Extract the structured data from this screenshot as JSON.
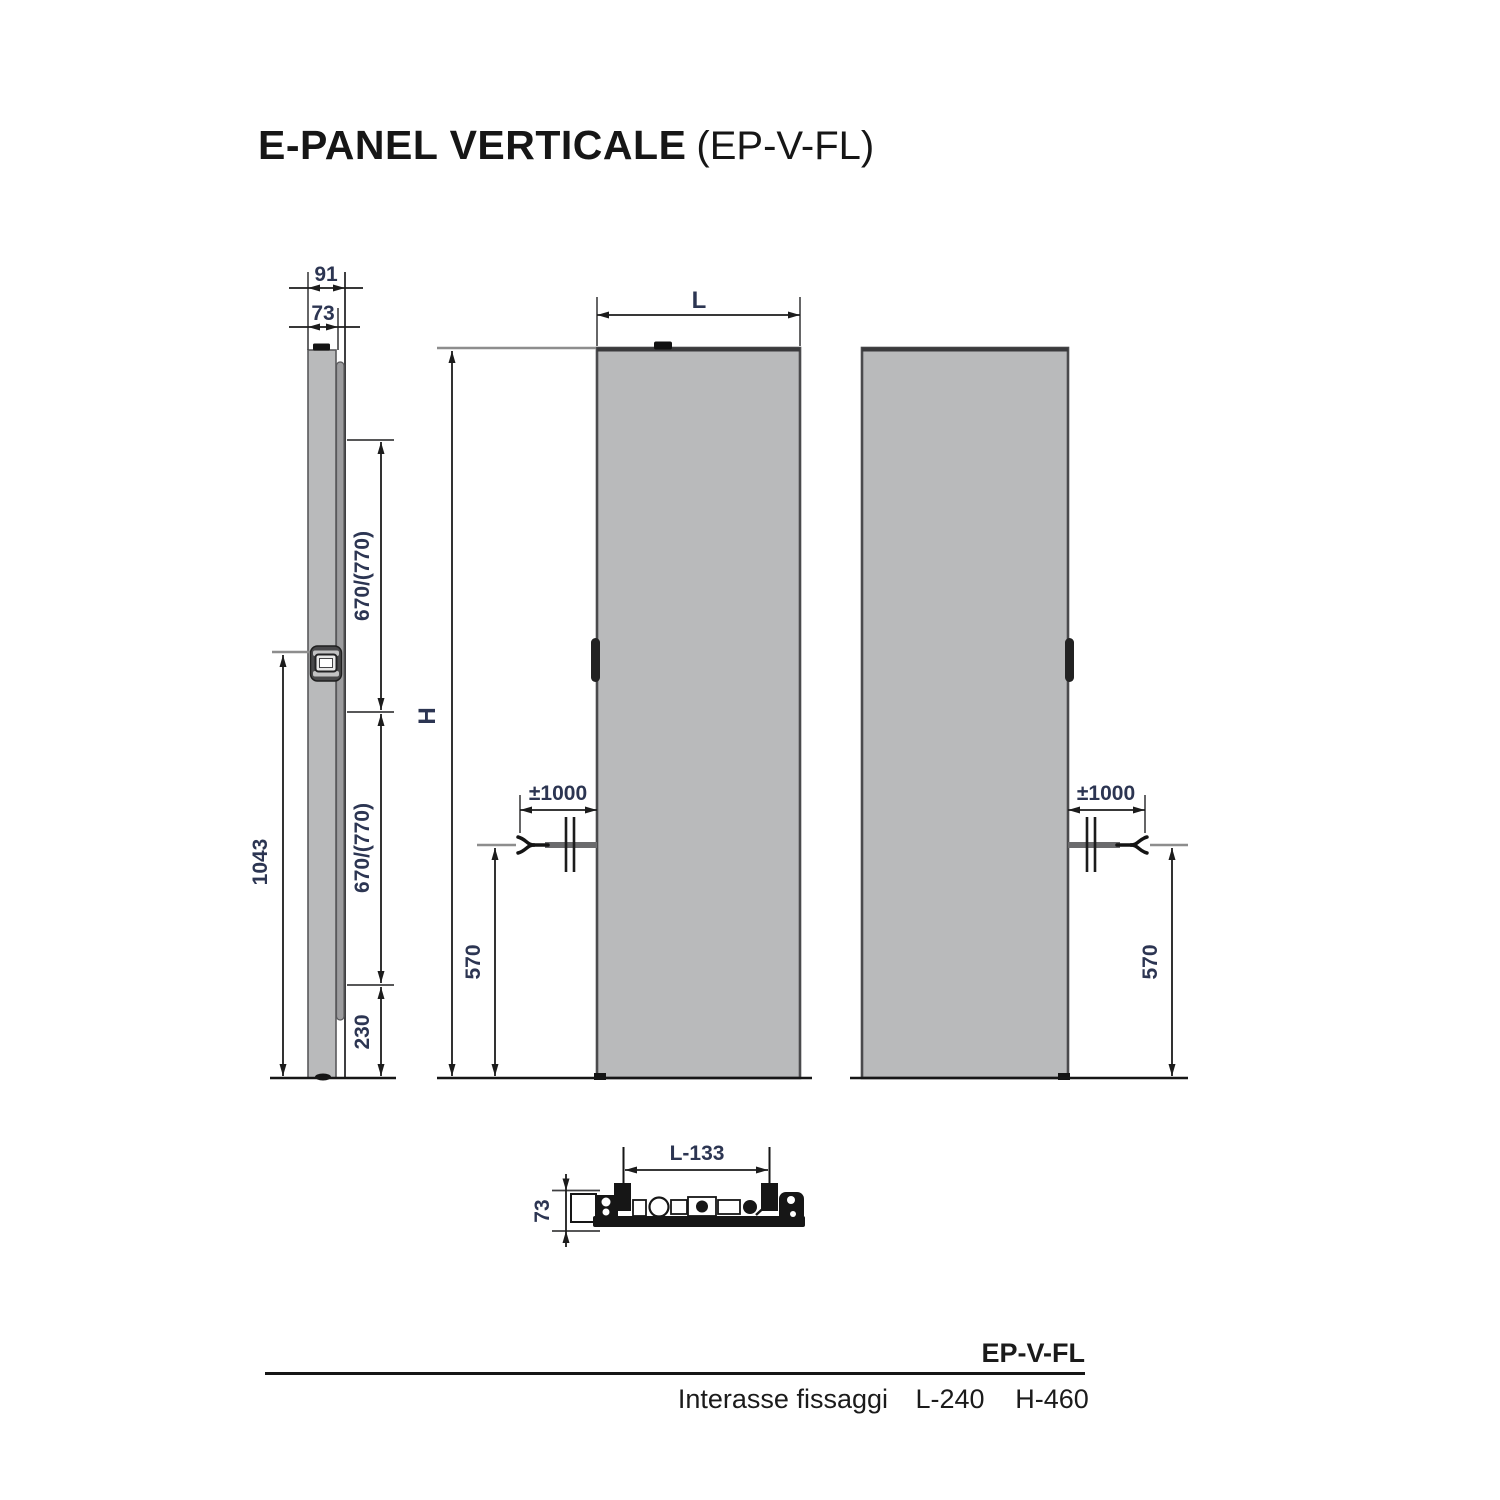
{
  "title": {
    "main": "E-PANEL VERTICALE",
    "code": "(EP-V-FL)"
  },
  "drawing": {
    "side_view": {
      "depth_total": "91",
      "depth_body": "73",
      "span_upper": "670/(770)",
      "span_lower": "670/(770)",
      "bottom_offset": "230",
      "bracket_height": "1043"
    },
    "front_view": {
      "width_label": "L",
      "height_label": "H",
      "cable_length": "±1000",
      "cable_height": "570"
    },
    "rear_view": {
      "cable_length": "±1000",
      "cable_height": "570"
    },
    "top_view": {
      "fixing_span": "L-133",
      "depth": "73"
    }
  },
  "footer": {
    "model": "EP-V-FL",
    "row_label": "Interasse fissaggi",
    "l_value": "L-240",
    "h_value": "H-460"
  },
  "colors": {
    "panel_fill": "#b9babb",
    "line": "#1c1c1c",
    "dim_text": "#2c3552",
    "reference_gray": "#8d8d8d"
  }
}
